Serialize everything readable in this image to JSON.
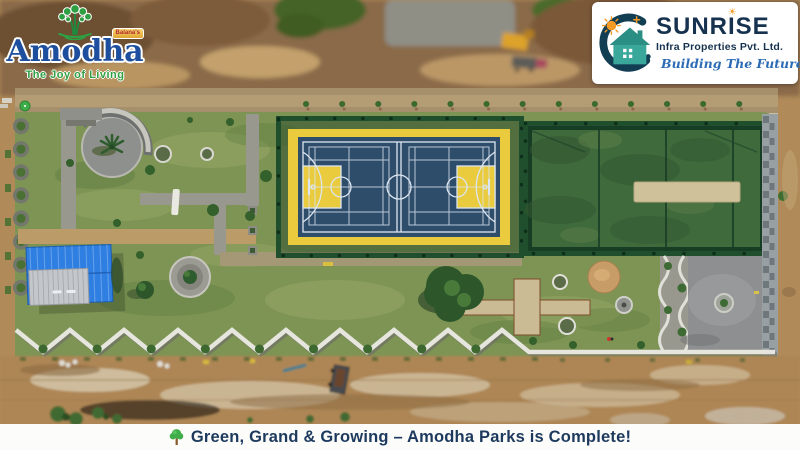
{
  "amodha_logo": {
    "brand": "Amodha",
    "tagline": "The Joy of Living",
    "badge_text": "Balana's"
  },
  "sunrise_logo": {
    "brand": "SUNRISE",
    "subtitle": "Infra Properties Pvt. Ltd.",
    "tagline": "Building The Future"
  },
  "banner": {
    "text": "Green, Grand & Growing – Amodha Parks is Complete!"
  },
  "icons": {
    "amodha_tree_icon": "green-tree",
    "sunrise_mark_icon": "hand-holding-house-with-sun",
    "sun_dot_icon": "sun",
    "banner_tree_icon": "green-tree"
  },
  "colors": {
    "amodha_blue": "#1d4f9e",
    "amodha_green": "#2ea043",
    "badge_red": "#b3262a",
    "sunrise_navy": "#16324f",
    "sunrise_dark": "#113e53",
    "sunrise_teal": "#3aa79b",
    "sunrise_orange": "#f59a23",
    "sunrise_script_blue": "#2d6cb5",
    "banner_navy": "#1d3a5e",
    "banner_tree_green": "#3fae4a",
    "court_blue": "#2e4d6b",
    "court_yellow": "#e9cb3d",
    "court_line": "#dce5f0",
    "turf_green": "#3f6a3c",
    "fence_green": "#1f4f2c",
    "lawn_green": "#7d9454",
    "roof_blue": "#2f7fe2",
    "pitch_beige": "#cfc199",
    "plaza_gray": "#8d8f91",
    "path_gray": "#98988e",
    "path_tan": "#bb9c68",
    "dirt_tan": "#b08a58",
    "wall_white": "#e6e6de"
  }
}
